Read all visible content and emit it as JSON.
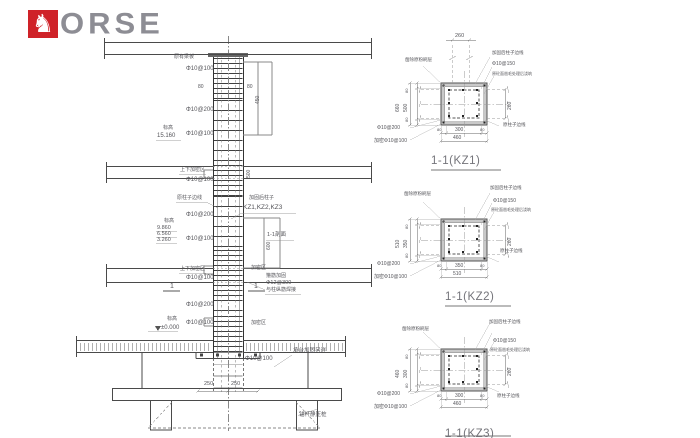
{
  "logo": {
    "text": "ORSE",
    "horse_icon": "♞",
    "red": "#cf2228",
    "gray": "#8d8d94"
  },
  "colors": {
    "line_dark": "#3f3f3f",
    "line_mid": "#777777",
    "line_light": "#bbbbbb",
    "paper": "#ffffff"
  },
  "annotations": {
    "elevation": [
      {
        "name": "note-beam-top",
        "text": "原有梁板",
        "x": 174,
        "y": 55,
        "size": 5
      },
      {
        "name": "stirrup-a",
        "text": "Φ10@100",
        "x": 186,
        "y": 66,
        "size": 6
      },
      {
        "name": "dim-80-left",
        "text": "80",
        "x": 198,
        "y": 85,
        "size": 5
      },
      {
        "name": "dim-80-right",
        "text": "80",
        "x": 247,
        "y": 85,
        "size": 5
      },
      {
        "name": "dim-450",
        "text": "450",
        "x": 256,
        "y": 104,
        "size": 5,
        "rot": true
      },
      {
        "name": "stirrup-b",
        "text": "Φ10@200",
        "x": 186,
        "y": 107,
        "size": 6
      },
      {
        "name": "elev-label-1",
        "text": "标高",
        "x": 163,
        "y": 126,
        "size": 5
      },
      {
        "name": "elev-value-1",
        "text": "15.160",
        "x": 157,
        "y": 133,
        "size": 6
      },
      {
        "name": "stirrup-c",
        "text": "Φ10@100",
        "x": 186,
        "y": 131,
        "size": 6
      },
      {
        "name": "dense-a",
        "text": "上下加密区",
        "x": 180,
        "y": 168,
        "size": 5
      },
      {
        "name": "stirrup-d",
        "text": "Φ10@100",
        "x": 186,
        "y": 177,
        "size": 6
      },
      {
        "name": "dim-500",
        "text": "500",
        "x": 247,
        "y": 178,
        "size": 5,
        "rot": true
      },
      {
        "name": "note-orig-edge",
        "text": "原柱子边线",
        "x": 177,
        "y": 196,
        "size": 5
      },
      {
        "name": "note-strengthened",
        "text": "加固后柱子",
        "x": 249,
        "y": 196,
        "size": 5
      },
      {
        "name": "note-kz-list",
        "text": "KZ1,KZ2,KZ3",
        "x": 243,
        "y": 205,
        "size": 6.5
      },
      {
        "name": "stirrup-e",
        "text": "Φ10@200",
        "x": 186,
        "y": 212,
        "size": 6
      },
      {
        "name": "elev-label-2",
        "text": "标高",
        "x": 164,
        "y": 219,
        "size": 5
      },
      {
        "name": "elev-value-2",
        "text": "9.860",
        "x": 157,
        "y": 226,
        "size": 5.5
      },
      {
        "name": "elev-value-3",
        "text": "6.560",
        "x": 157,
        "y": 232,
        "size": 5.5
      },
      {
        "name": "elev-value-4",
        "text": "3.260",
        "x": 157,
        "y": 238,
        "size": 5.5
      },
      {
        "name": "stirrup-f",
        "text": "Φ10@100",
        "x": 186,
        "y": 236,
        "size": 6
      },
      {
        "name": "note-section-ref",
        "text": "1-1剖面",
        "x": 267,
        "y": 233,
        "size": 5.5
      },
      {
        "name": "dim-600",
        "text": "600",
        "x": 267,
        "y": 250,
        "size": 5,
        "rot": true
      },
      {
        "name": "dense-b",
        "text": "上下加密区",
        "x": 180,
        "y": 267,
        "size": 5
      },
      {
        "name": "stirrup-g",
        "text": "Φ10@100",
        "x": 186,
        "y": 275,
        "size": 6
      },
      {
        "name": "dense-c",
        "text": "加密区",
        "x": 251,
        "y": 266,
        "size": 5
      },
      {
        "name": "note-hoop-1",
        "text": "箍筋加固",
        "x": 266,
        "y": 274,
        "size": 5
      },
      {
        "name": "note-hoop-2",
        "text": "Φ12@300",
        "x": 266,
        "y": 281,
        "size": 5.5
      },
      {
        "name": "note-hoop-3",
        "text": "与柱纵筋焊接",
        "x": 266,
        "y": 288,
        "size": 5
      },
      {
        "name": "cut-mark-left",
        "text": "1",
        "x": 170,
        "y": 283,
        "size": 7
      },
      {
        "name": "cut-mark-right",
        "text": "1",
        "x": 254,
        "y": 283,
        "size": 7
      },
      {
        "name": "stirrup-h",
        "text": "Φ10@200",
        "x": 186,
        "y": 302,
        "size": 6
      },
      {
        "name": "elev-label-3",
        "text": "标高",
        "x": 167,
        "y": 317,
        "size": 5
      },
      {
        "name": "elev-value-0",
        "text": "±0.000",
        "x": 161,
        "y": 325,
        "size": 6
      },
      {
        "name": "stirrup-i",
        "text": "Φ10@100",
        "x": 186,
        "y": 320,
        "size": 6
      },
      {
        "name": "dense-d",
        "text": "加密区",
        "x": 251,
        "y": 321,
        "size": 5
      },
      {
        "name": "stirrup-j",
        "text": "Φ10@100",
        "x": 245,
        "y": 356,
        "size": 6
      },
      {
        "name": "note-cap",
        "text": "承台加固另详",
        "x": 293,
        "y": 349,
        "size": 5.5
      },
      {
        "name": "dim-250-left",
        "text": "250",
        "x": 204,
        "y": 382,
        "size": 5.5
      },
      {
        "name": "dim-250-right",
        "text": "250",
        "x": 231,
        "y": 382,
        "size": 5.5
      },
      {
        "name": "note-pile",
        "text": "锚杆静压桩",
        "x": 299,
        "y": 413,
        "size": 5.5
      }
    ],
    "kz1": [
      {
        "name": "kz1-dim-top",
        "text": "260",
        "x": 455,
        "y": 34,
        "size": 5.5
      },
      {
        "name": "kz1-note-plaster",
        "text": "凿除原粉刷层",
        "x": 405,
        "y": 58,
        "size": 4.5
      },
      {
        "name": "kz1-note-edge",
        "text": "加固后柱子边线",
        "x": 492,
        "y": 51,
        "size": 4.5
      },
      {
        "name": "kz1-note-stirrup",
        "text": "Φ10@150",
        "x": 492,
        "y": 62,
        "size": 5
      },
      {
        "name": "kz1-note-rough",
        "text": "原砼面凿毛处理后浇筑",
        "x": 492,
        "y": 72,
        "size": 4
      },
      {
        "name": "kz1-dim-left-outer",
        "text": "660",
        "x": 396,
        "y": 112,
        "size": 5,
        "rot": true
      },
      {
        "name": "kz1-dim-left-inner",
        "text": "500",
        "x": 404,
        "y": 112,
        "size": 5,
        "rot": true
      },
      {
        "name": "kz1-dim-80-top",
        "text": "80",
        "x": 405,
        "y": 93,
        "size": 4,
        "rot": true
      },
      {
        "name": "kz1-dim-80-bot",
        "text": "80",
        "x": 405,
        "y": 122,
        "size": 4,
        "rot": true
      },
      {
        "name": "kz1-dim-right",
        "text": "260",
        "x": 508,
        "y": 110,
        "size": 5,
        "rot": true
      },
      {
        "name": "kz1-note-orig",
        "text": "原柱子边线",
        "x": 503,
        "y": 123,
        "size": 4.5
      },
      {
        "name": "kz1-stirrup-1",
        "text": "Φ10@200",
        "x": 377,
        "y": 126,
        "size": 5
      },
      {
        "name": "kz1-stirrup-2",
        "text": "加密Φ10@100",
        "x": 374,
        "y": 139,
        "size": 5
      },
      {
        "name": "kz1-dim-bot-80l",
        "text": "80",
        "x": 437,
        "y": 128,
        "size": 4
      },
      {
        "name": "kz1-dim-bot",
        "text": "300",
        "x": 455,
        "y": 128,
        "size": 5
      },
      {
        "name": "kz1-dim-bot-80r",
        "text": "80",
        "x": 480,
        "y": 128,
        "size": 4
      },
      {
        "name": "kz1-dim-bot-outer",
        "text": "460",
        "x": 453,
        "y": 136,
        "size": 5
      }
    ],
    "kz2": [
      {
        "name": "kz2-note-plaster",
        "text": "凿除原粉刷层",
        "x": 404,
        "y": 192,
        "size": 4.5
      },
      {
        "name": "kz2-note-edge",
        "text": "加固后柱子边线",
        "x": 490,
        "y": 186,
        "size": 4.5
      },
      {
        "name": "kz2-note-stirrup",
        "text": "Φ10@150",
        "x": 493,
        "y": 199,
        "size": 5
      },
      {
        "name": "kz2-note-rough",
        "text": "原砼面凿毛处理后浇筑",
        "x": 491,
        "y": 208,
        "size": 4
      },
      {
        "name": "kz2-dim-left-outer",
        "text": "510",
        "x": 396,
        "y": 248,
        "size": 5,
        "rot": true
      },
      {
        "name": "kz2-dim-left-inner",
        "text": "350",
        "x": 404,
        "y": 248,
        "size": 5,
        "rot": true
      },
      {
        "name": "kz2-dim-80-top",
        "text": "80",
        "x": 405,
        "y": 229,
        "size": 4,
        "rot": true
      },
      {
        "name": "kz2-dim-80-bot",
        "text": "80",
        "x": 405,
        "y": 258,
        "size": 4,
        "rot": true
      },
      {
        "name": "kz2-dim-right",
        "text": "260",
        "x": 508,
        "y": 246,
        "size": 5,
        "rot": true
      },
      {
        "name": "kz2-note-orig",
        "text": "原柱子边线",
        "x": 500,
        "y": 249,
        "size": 4.5
      },
      {
        "name": "kz2-stirrup-1",
        "text": "Φ10@200",
        "x": 377,
        "y": 262,
        "size": 5
      },
      {
        "name": "kz2-stirrup-2",
        "text": "加密Φ10@100",
        "x": 374,
        "y": 275,
        "size": 5
      },
      {
        "name": "kz2-dim-bot-80l",
        "text": "80",
        "x": 437,
        "y": 264,
        "size": 4
      },
      {
        "name": "kz2-dim-bot",
        "text": "350",
        "x": 455,
        "y": 264,
        "size": 5
      },
      {
        "name": "kz2-dim-bot-80r",
        "text": "80",
        "x": 480,
        "y": 264,
        "size": 4
      },
      {
        "name": "kz2-dim-bot-outer",
        "text": "510",
        "x": 453,
        "y": 272,
        "size": 5
      }
    ],
    "kz3": [
      {
        "name": "kz3-note-plaster",
        "text": "凿除原粉刷层",
        "x": 402,
        "y": 327,
        "size": 4.5
      },
      {
        "name": "kz3-note-edge",
        "text": "加固后柱子边线",
        "x": 489,
        "y": 320,
        "size": 4.5
      },
      {
        "name": "kz3-note-stirrup",
        "text": "Φ10@150",
        "x": 493,
        "y": 339,
        "size": 5
      },
      {
        "name": "kz3-note-rough",
        "text": "原砼面凿毛处理后浇筑",
        "x": 490,
        "y": 348,
        "size": 4
      },
      {
        "name": "kz3-dim-left-outer",
        "text": "460",
        "x": 396,
        "y": 378,
        "size": 5,
        "rot": true
      },
      {
        "name": "kz3-dim-left-inner",
        "text": "300",
        "x": 404,
        "y": 378,
        "size": 5,
        "rot": true
      },
      {
        "name": "kz3-dim-80-top",
        "text": "80",
        "x": 405,
        "y": 359,
        "size": 4,
        "rot": true
      },
      {
        "name": "kz3-dim-80-bot",
        "text": "80",
        "x": 405,
        "y": 388,
        "size": 4,
        "rot": true
      },
      {
        "name": "kz3-dim-right",
        "text": "260",
        "x": 508,
        "y": 376,
        "size": 5,
        "rot": true
      },
      {
        "name": "kz3-note-orig",
        "text": "原柱子边线",
        "x": 497,
        "y": 394,
        "size": 4.5
      },
      {
        "name": "kz3-stirrup-1",
        "text": "Φ10@200",
        "x": 377,
        "y": 392,
        "size": 5
      },
      {
        "name": "kz3-stirrup-2",
        "text": "加密Φ10@100",
        "x": 374,
        "y": 405,
        "size": 5
      },
      {
        "name": "kz3-dim-bot-80l",
        "text": "80",
        "x": 437,
        "y": 394,
        "size": 4
      },
      {
        "name": "kz3-dim-bot",
        "text": "300",
        "x": 455,
        "y": 394,
        "size": 5
      },
      {
        "name": "kz3-dim-bot-80r",
        "text": "80",
        "x": 480,
        "y": 394,
        "size": 4
      },
      {
        "name": "kz3-dim-bot-outer",
        "text": "460",
        "x": 453,
        "y": 402,
        "size": 5
      }
    ],
    "titles": [
      {
        "name": "section-title-kz1",
        "text": "1-1(KZ1)",
        "x": 431,
        "y": 156,
        "cls": "title"
      },
      {
        "name": "section-title-kz2",
        "text": "1-1(KZ2)",
        "x": 445,
        "y": 292,
        "cls": "title"
      },
      {
        "name": "section-title-kz3",
        "text": "1-1(KZ3)",
        "x": 445,
        "y": 429,
        "cls": "title"
      }
    ]
  }
}
